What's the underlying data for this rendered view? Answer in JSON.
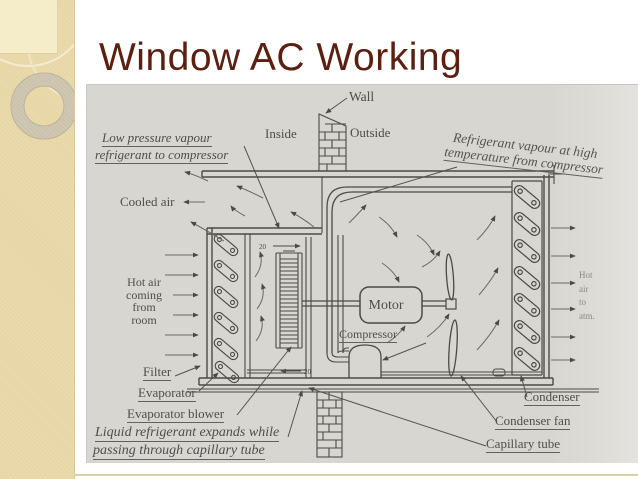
{
  "slide": {
    "title": "Window AC Working"
  },
  "colors": {
    "title_color": "#5c2011",
    "sidebar_color": "#e8d7a6",
    "sidebar_square_color": "#f5ecca",
    "diagram_background": "#d7d6d1",
    "ink_color": "#4b4a43"
  },
  "diagram": {
    "labels": {
      "wall": "Wall",
      "inside": "Inside",
      "outside": "Outside",
      "low_pressure": [
        "Low pressure vapour",
        "refrigerant to compressor"
      ],
      "refrigerant_high": [
        "Refrigerant vapour at high",
        "temperature from compressor"
      ],
      "cooled_air": "Cooled air",
      "hot_air_room": [
        "Hot air",
        "coming",
        "from",
        "room"
      ],
      "filter": "Filter",
      "evaporator": "Evaporator",
      "evaporator_blower": "Evaporator blower",
      "liquid_expansion": [
        "Liquid refrigerant expands while",
        "passing through capillary tube"
      ],
      "motor": "Motor",
      "compressor": "Compressor",
      "condenser": "Condenser",
      "condenser_fan": "Condenser fan",
      "capillary_tube": "Capillary tube",
      "hot_air_atm": [
        "Hot",
        "air",
        "to",
        "atm."
      ],
      "flow_marker": "20"
    }
  }
}
